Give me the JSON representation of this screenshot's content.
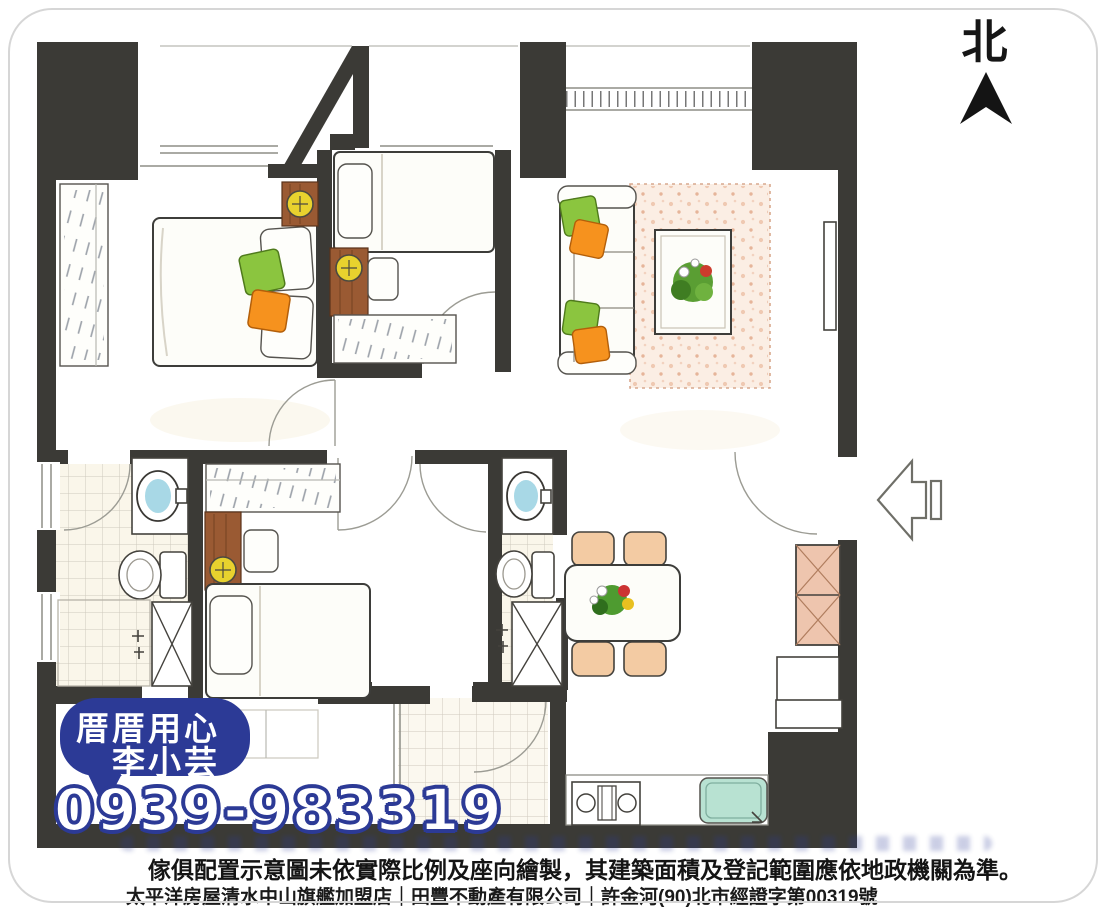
{
  "compass": {
    "label": "北"
  },
  "agent_stamp": {
    "tagline_line1": "厝厝用心",
    "tagline_line2": "李小芸",
    "phone": "0939-983319"
  },
  "footer": {
    "disclaimer": "傢俱配置示意圖未依實際比例及座向繪製，其建築面積及登記範圍應依地政機關為準。",
    "agency_line": "太平洋房屋清水中山旗艦加盟店｜田豐不動產有限公司｜許金河(90)北市經證字第00319號"
  },
  "colors": {
    "wall": "#3b3a36",
    "stamp_blue": "#2c3a96",
    "pillow_green": "#8bc53f",
    "pillow_orange": "#f6921e",
    "lamp_yellow": "#e8d22e",
    "wood_brown": "#9a5a33",
    "sink_blue": "#a8d8e6",
    "chair_peach": "#f3cba3",
    "rug_pink": "#fbeee4",
    "kitchen_sink_teal": "#b8e2d2",
    "cabinet_peach": "#eec5ae"
  }
}
